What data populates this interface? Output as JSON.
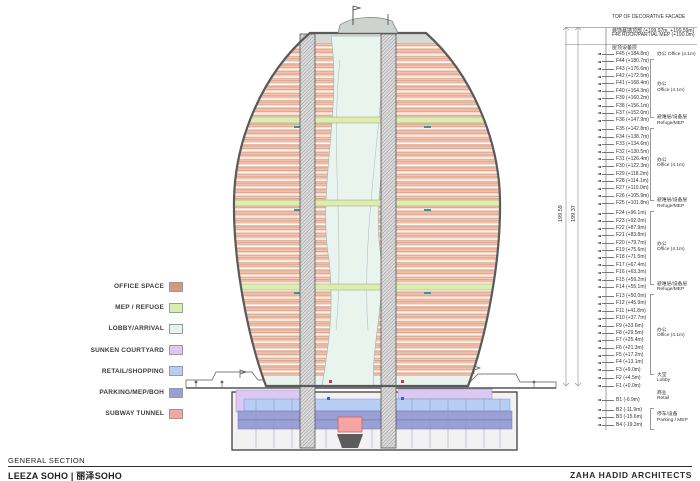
{
  "title_block": {
    "drawing_title": "GENERAL SECTION",
    "project_name": "LEEZA SOHO | 丽泽SOHO",
    "firm_name": "ZAHA HADID ARCHITECTS"
  },
  "legend": {
    "items": [
      {
        "label": "OFFICE SPACE",
        "color": "#d6977c"
      },
      {
        "label": "MEP / REFUGE",
        "color": "#dcedaf"
      },
      {
        "label": "LOBBY/ARRIVAL",
        "color": "#e6f4ef"
      },
      {
        "label": "SUNKEN COURTYARD",
        "color": "#dbc9f1"
      },
      {
        "label": "RETAIL/SHOPPING",
        "color": "#b7cdf3"
      },
      {
        "label": "PARKING/MEP/BOH",
        "color": "#9ba0d4"
      },
      {
        "label": "SUBWAY TUNNEL",
        "color": "#f4a5a4"
      }
    ]
  },
  "annotations": {
    "top_notes": [
      {
        "line1": "TOP OF DECORATIVE FACADE",
        "line2": "装饰幕墙顶部 (+199.97m, +199.59m)",
        "elev": 199.59
      },
      {
        "line1": "F46 ROOF/PARTIAL MEP (+190.0m)",
        "line2": "屋顶设备层",
        "elev": 190.0
      }
    ],
    "overall_dims": [
      "199.59",
      "199.37"
    ],
    "floors": [
      [
        "F45",
        184.8,
        "F45 (+184.8m)"
      ],
      [
        "F44",
        180.7,
        "F44 (+180.7m)"
      ],
      [
        "F43",
        176.6,
        "F43 (+176.6m)"
      ],
      [
        "F42",
        172.5,
        "F42 (+172.5m)"
      ],
      [
        "F41",
        168.4,
        "F41 (+168.4m)"
      ],
      [
        "F40",
        164.3,
        "F40 (+164.3m)"
      ],
      [
        "F39",
        160.2,
        "F39 (+160.2m)"
      ],
      [
        "F38",
        156.1,
        "F38 (+156.1m)"
      ],
      [
        "F37",
        152.0,
        "F37 (+152.0m)"
      ],
      [
        "F36",
        147.9,
        "F36 (+147.9m)"
      ],
      [
        "F35",
        142.8,
        "F35 (+142.8m)"
      ],
      [
        "F34",
        138.7,
        "F34 (+138.7m)"
      ],
      [
        "F33",
        134.6,
        "F33 (+134.6m)"
      ],
      [
        "F32",
        130.5,
        "F32 (+130.5m)"
      ],
      [
        "F31",
        126.4,
        "F31 (+126.4m)"
      ],
      [
        "F30",
        122.3,
        "F30 (+122.3m)"
      ],
      [
        "F29",
        118.2,
        "F29 (+118.2m)"
      ],
      [
        "F28",
        114.1,
        "F28 (+114.1m)"
      ],
      [
        "F27",
        110.0,
        "F27 (+110.0m)"
      ],
      [
        "F26",
        105.9,
        "F26 (+105.9m)"
      ],
      [
        "F25",
        101.8,
        "F25 (+101.8m)"
      ],
      [
        "F24",
        96.1,
        "F24 (+96.1m)"
      ],
      [
        "F23",
        92.0,
        "F23 (+92.0m)"
      ],
      [
        "F22",
        87.9,
        "F22 (+87.9m)"
      ],
      [
        "F21",
        83.8,
        "F21 (+83.8m)"
      ],
      [
        "F20",
        79.7,
        "F20 (+79.7m)"
      ],
      [
        "F19",
        75.6,
        "F19 (+75.6m)"
      ],
      [
        "F18",
        71.5,
        "F18 (+71.5m)"
      ],
      [
        "F17",
        67.4,
        "F17 (+67.4m)"
      ],
      [
        "F16",
        63.3,
        "F16 (+63.3m)"
      ],
      [
        "F15",
        59.2,
        "F15 (+59.2m)"
      ],
      [
        "F14",
        55.1,
        "F14 (+55.1m)"
      ],
      [
        "F13",
        50.0,
        "F13 (+50.0m)"
      ],
      [
        "F12",
        45.9,
        "F12 (+45.9m)"
      ],
      [
        "F11",
        41.8,
        "F11 (+41.8m)"
      ],
      [
        "F10",
        37.7,
        "F10 (+37.7m)"
      ],
      [
        "F9",
        33.6,
        "F9 (+33.6m)"
      ],
      [
        "F8",
        29.5,
        "F8 (+29.5m)"
      ],
      [
        "F7",
        25.4,
        "F7 (+25.4m)"
      ],
      [
        "F6",
        21.3,
        "F6 (+21.3m)"
      ],
      [
        "F5",
        17.2,
        "F5 (+17.2m)"
      ],
      [
        "F4",
        13.1,
        "F4 (+13.1m)"
      ],
      [
        "F3",
        9.0,
        "F3 (+9.0m)"
      ],
      [
        "F2",
        4.5,
        "F2 (+4.5m)"
      ],
      [
        "F1",
        0.0,
        "F1 (+0.0m)"
      ],
      [
        "B1",
        -6.9,
        "B1 (-6.9m)"
      ],
      [
        "B2",
        -11.9,
        "B2 (-11.9m)"
      ],
      [
        "B3",
        -15.6,
        "B3 (-15.6m)"
      ],
      [
        "B4",
        -19.3,
        "B4 (-19.3m)"
      ]
    ],
    "groups": [
      {
        "cn": "办公",
        "en": "Office (4.1m)",
        "top": 184.8,
        "bottom": 184.8,
        "bracket": false,
        "inline": true
      },
      {
        "cn": "办公",
        "en": "Office (4.1m)",
        "top": 180.7,
        "bottom": 152.0,
        "bracket": true,
        "inline": false
      },
      {
        "cn": "避难层/设备层",
        "en": "Refuge/MEP",
        "top": 147.9,
        "bottom": 147.9,
        "bracket": false,
        "inline": false
      },
      {
        "cn": "办公",
        "en": "Office (4.1m)",
        "top": 142.8,
        "bottom": 105.9,
        "bracket": true,
        "inline": false
      },
      {
        "cn": "避难层/设备层",
        "en": "Refuge/MEP",
        "top": 101.8,
        "bottom": 101.8,
        "bracket": false,
        "inline": false
      },
      {
        "cn": "办公",
        "en": "Office (4.1m)",
        "top": 96.1,
        "bottom": 59.2,
        "bracket": true,
        "inline": false
      },
      {
        "cn": "避难层/设备层",
        "en": "Refuge/MEP",
        "top": 55.1,
        "bottom": 55.1,
        "bracket": false,
        "inline": false
      },
      {
        "cn": "办公",
        "en": "Office (4.1m)",
        "top": 50.0,
        "bottom": 9.0,
        "bracket": true,
        "inline": false
      },
      {
        "cn": "大堂",
        "en": "Lobby",
        "top": 4.5,
        "bottom": 4.5,
        "bracket": false,
        "inline": false
      },
      {
        "cn": "商业",
        "en": "Retail",
        "top": -5.0,
        "bottom": -5.0,
        "bracket": false,
        "inline": false
      },
      {
        "cn": "停车/设备",
        "en": "Parking / MEP",
        "top": -11.9,
        "bottom": -19.3,
        "bracket": true,
        "inline": false
      }
    ]
  }
}
